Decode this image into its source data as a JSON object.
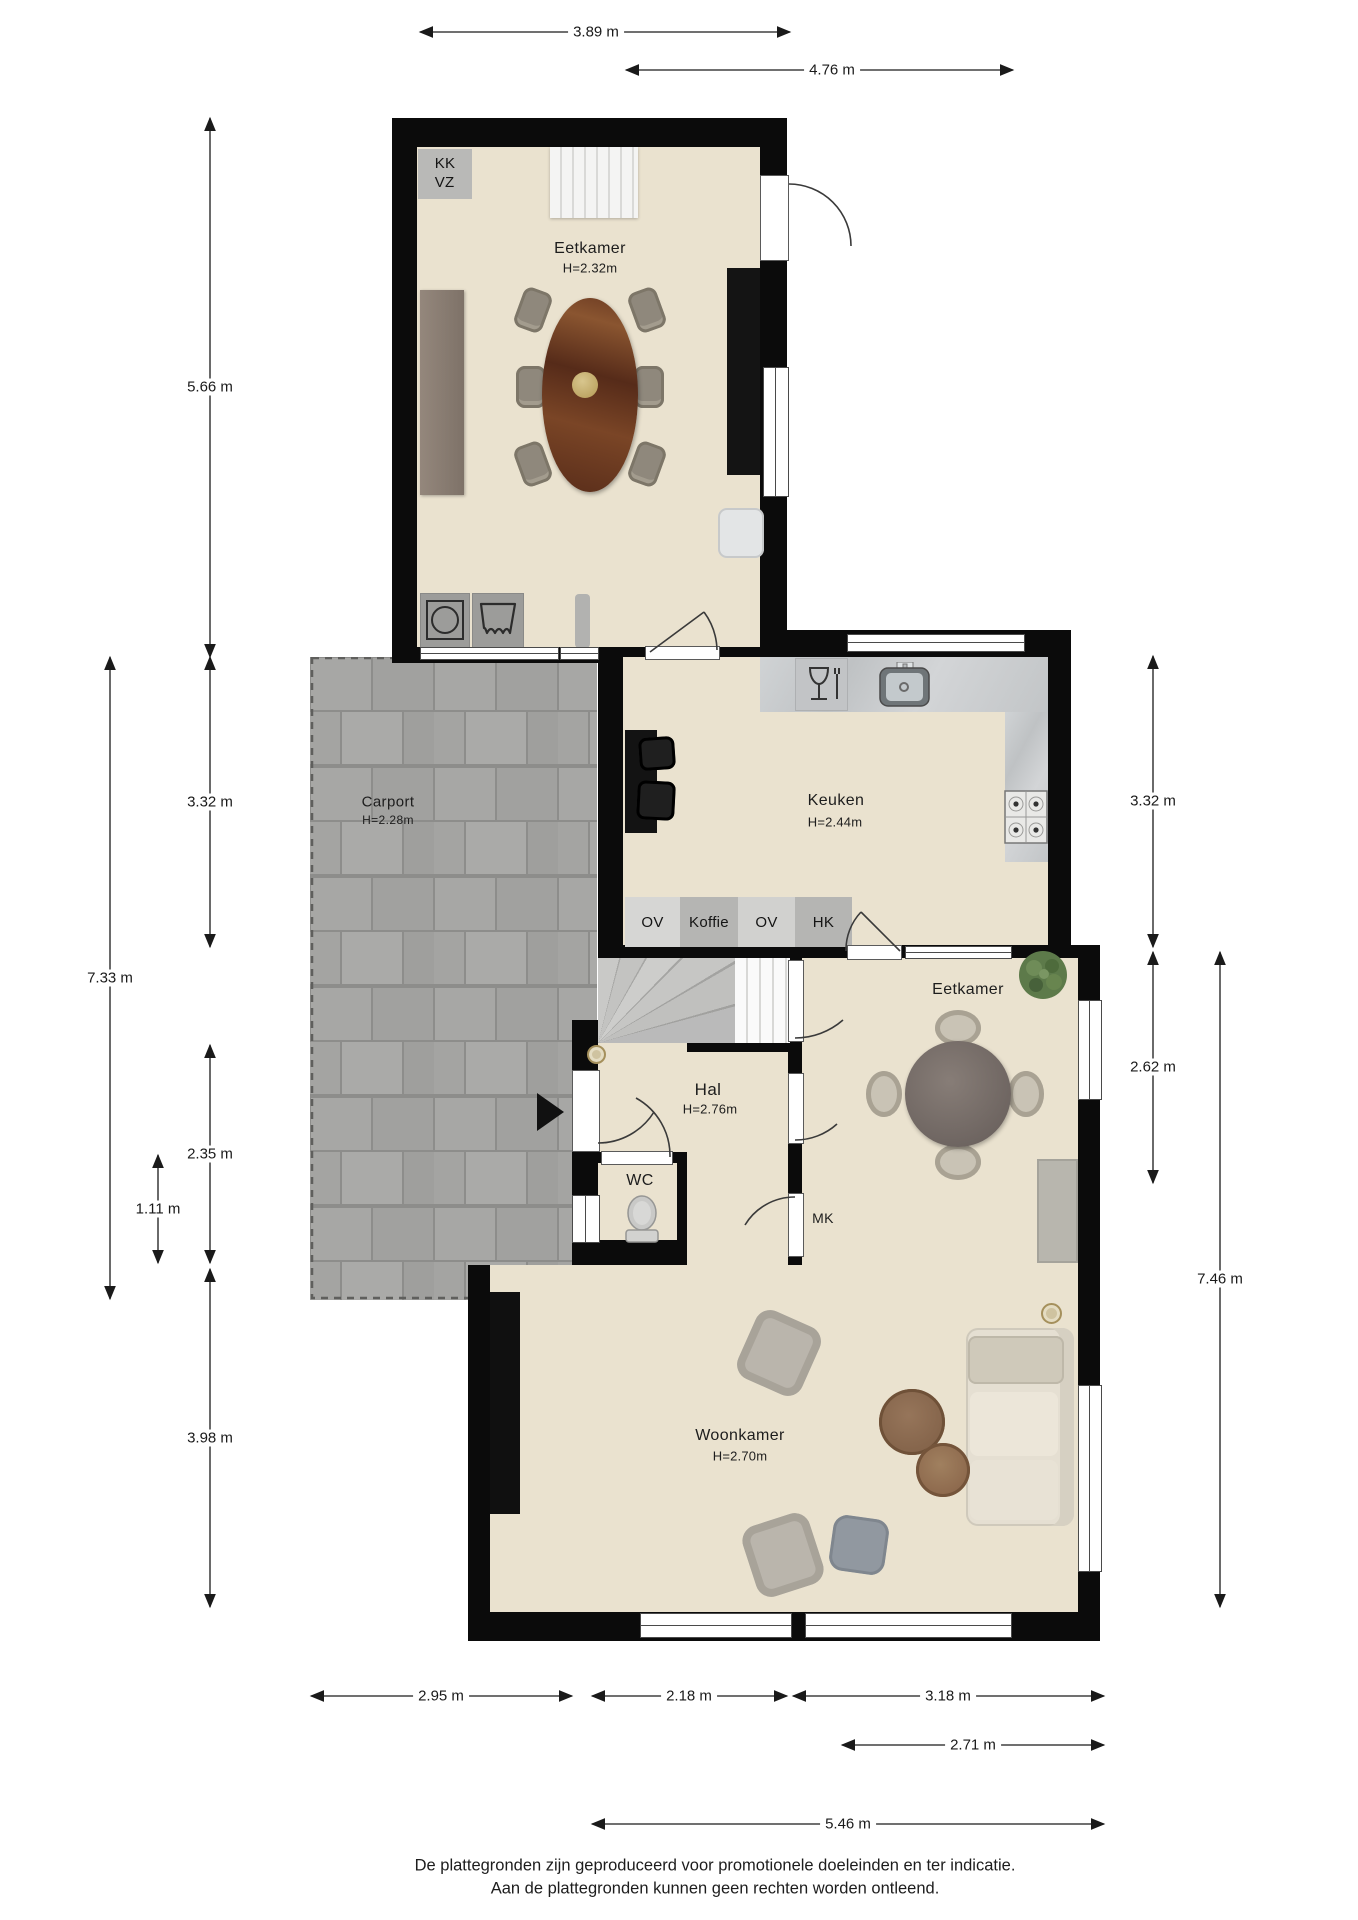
{
  "title": "Plattegrond begane grond",
  "colors": {
    "wall": "#0b0b0b",
    "floor": "#eae2cf",
    "carport_tile": "#a6a6a4",
    "counter_marble": "#c9cbcd",
    "table_wood": "#6e3c24",
    "plant_green": "#5d7a4a"
  },
  "rooms": {
    "eetkamer_boven": {
      "label": "Eetkamer",
      "height": "H=2.32m"
    },
    "keuken": {
      "label": "Keuken",
      "height": "H=2.44m"
    },
    "carport": {
      "label": "Carport",
      "height": "H=2.28m"
    },
    "hal": {
      "label": "Hal",
      "height": "H=2.76m"
    },
    "wc": {
      "label": "WC"
    },
    "mk": {
      "label": "MK"
    },
    "eetkamer": {
      "label": "Eetkamer"
    },
    "woonkamer": {
      "label": "Woonkamer",
      "height": "H=2.70m"
    }
  },
  "tags": {
    "kk": "KK",
    "vz": "VZ",
    "ov1": "OV",
    "koffie": "Koffie",
    "ov2": "OV",
    "hk": "HK"
  },
  "dimensions": {
    "top": [
      "3.89 m",
      "4.76 m"
    ],
    "left": [
      "5.66 m",
      "3.32 m",
      "7.33 m",
      "2.35 m",
      "1.11 m",
      "3.98 m"
    ],
    "right": [
      "3.32 m",
      "2.62 m",
      "7.46 m"
    ],
    "bottom": [
      "2.95 m",
      "2.18 m",
      "3.18 m",
      "2.71 m",
      "5.46 m"
    ]
  },
  "footer": {
    "line1": "De plattegronden zijn geproduceerd voor promotionele doeleinden en ter indicatie.",
    "line2": "Aan de plattegronden kunnen geen rechten worden ontleend."
  },
  "icons": [
    "washer-icon",
    "dryer-icon",
    "dishwasher-icon",
    "sink-icon",
    "stove-icon",
    "toilet-icon",
    "plant-icon",
    "entrance-arrow-icon",
    "ceiling-lamp-icon"
  ]
}
